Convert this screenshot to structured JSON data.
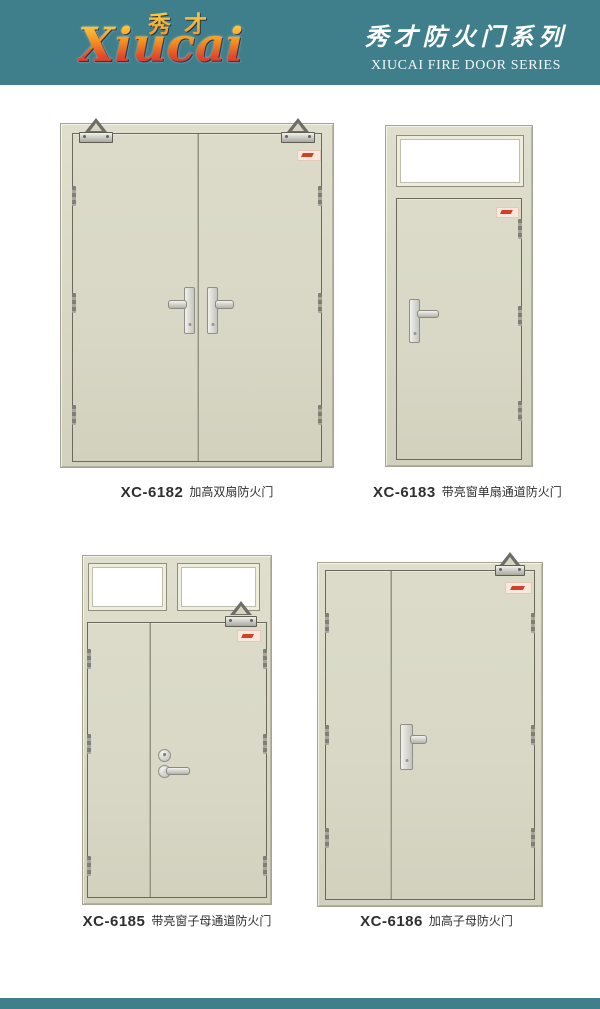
{
  "colors": {
    "teal": "#3e7f8b",
    "door-leaf": "#d9d8c6",
    "door-frame": "#d8d6c2",
    "door-outline": "#6a695b",
    "glass": "#ffffff",
    "label-pink": "#f8e7dd",
    "label-red": "#cf4128",
    "caption-text": "#2f2f2f",
    "logo-gold": "#ffd948",
    "logo-orange": "#f6921e",
    "logo-red": "#e04a2a",
    "logo-crimson": "#bf1e4b",
    "header-text": "#ffffff"
  },
  "header": {
    "logo": {
      "chinese": "秀才",
      "latin": "Xiucai"
    },
    "series_title_cn": "秀才防火门系列",
    "series_title_en": "XIUCAI FIRE DOOR SERIES"
  },
  "products": [
    {
      "code": "XC-6182",
      "name": "加高双扇防火门"
    },
    {
      "code": "XC-6183",
      "name": "带亮窗单扇通道防火门"
    },
    {
      "code": "XC-6185",
      "name": "带亮窗子母通道防火门"
    },
    {
      "code": "XC-6186",
      "name": "加高子母防火门"
    }
  ]
}
